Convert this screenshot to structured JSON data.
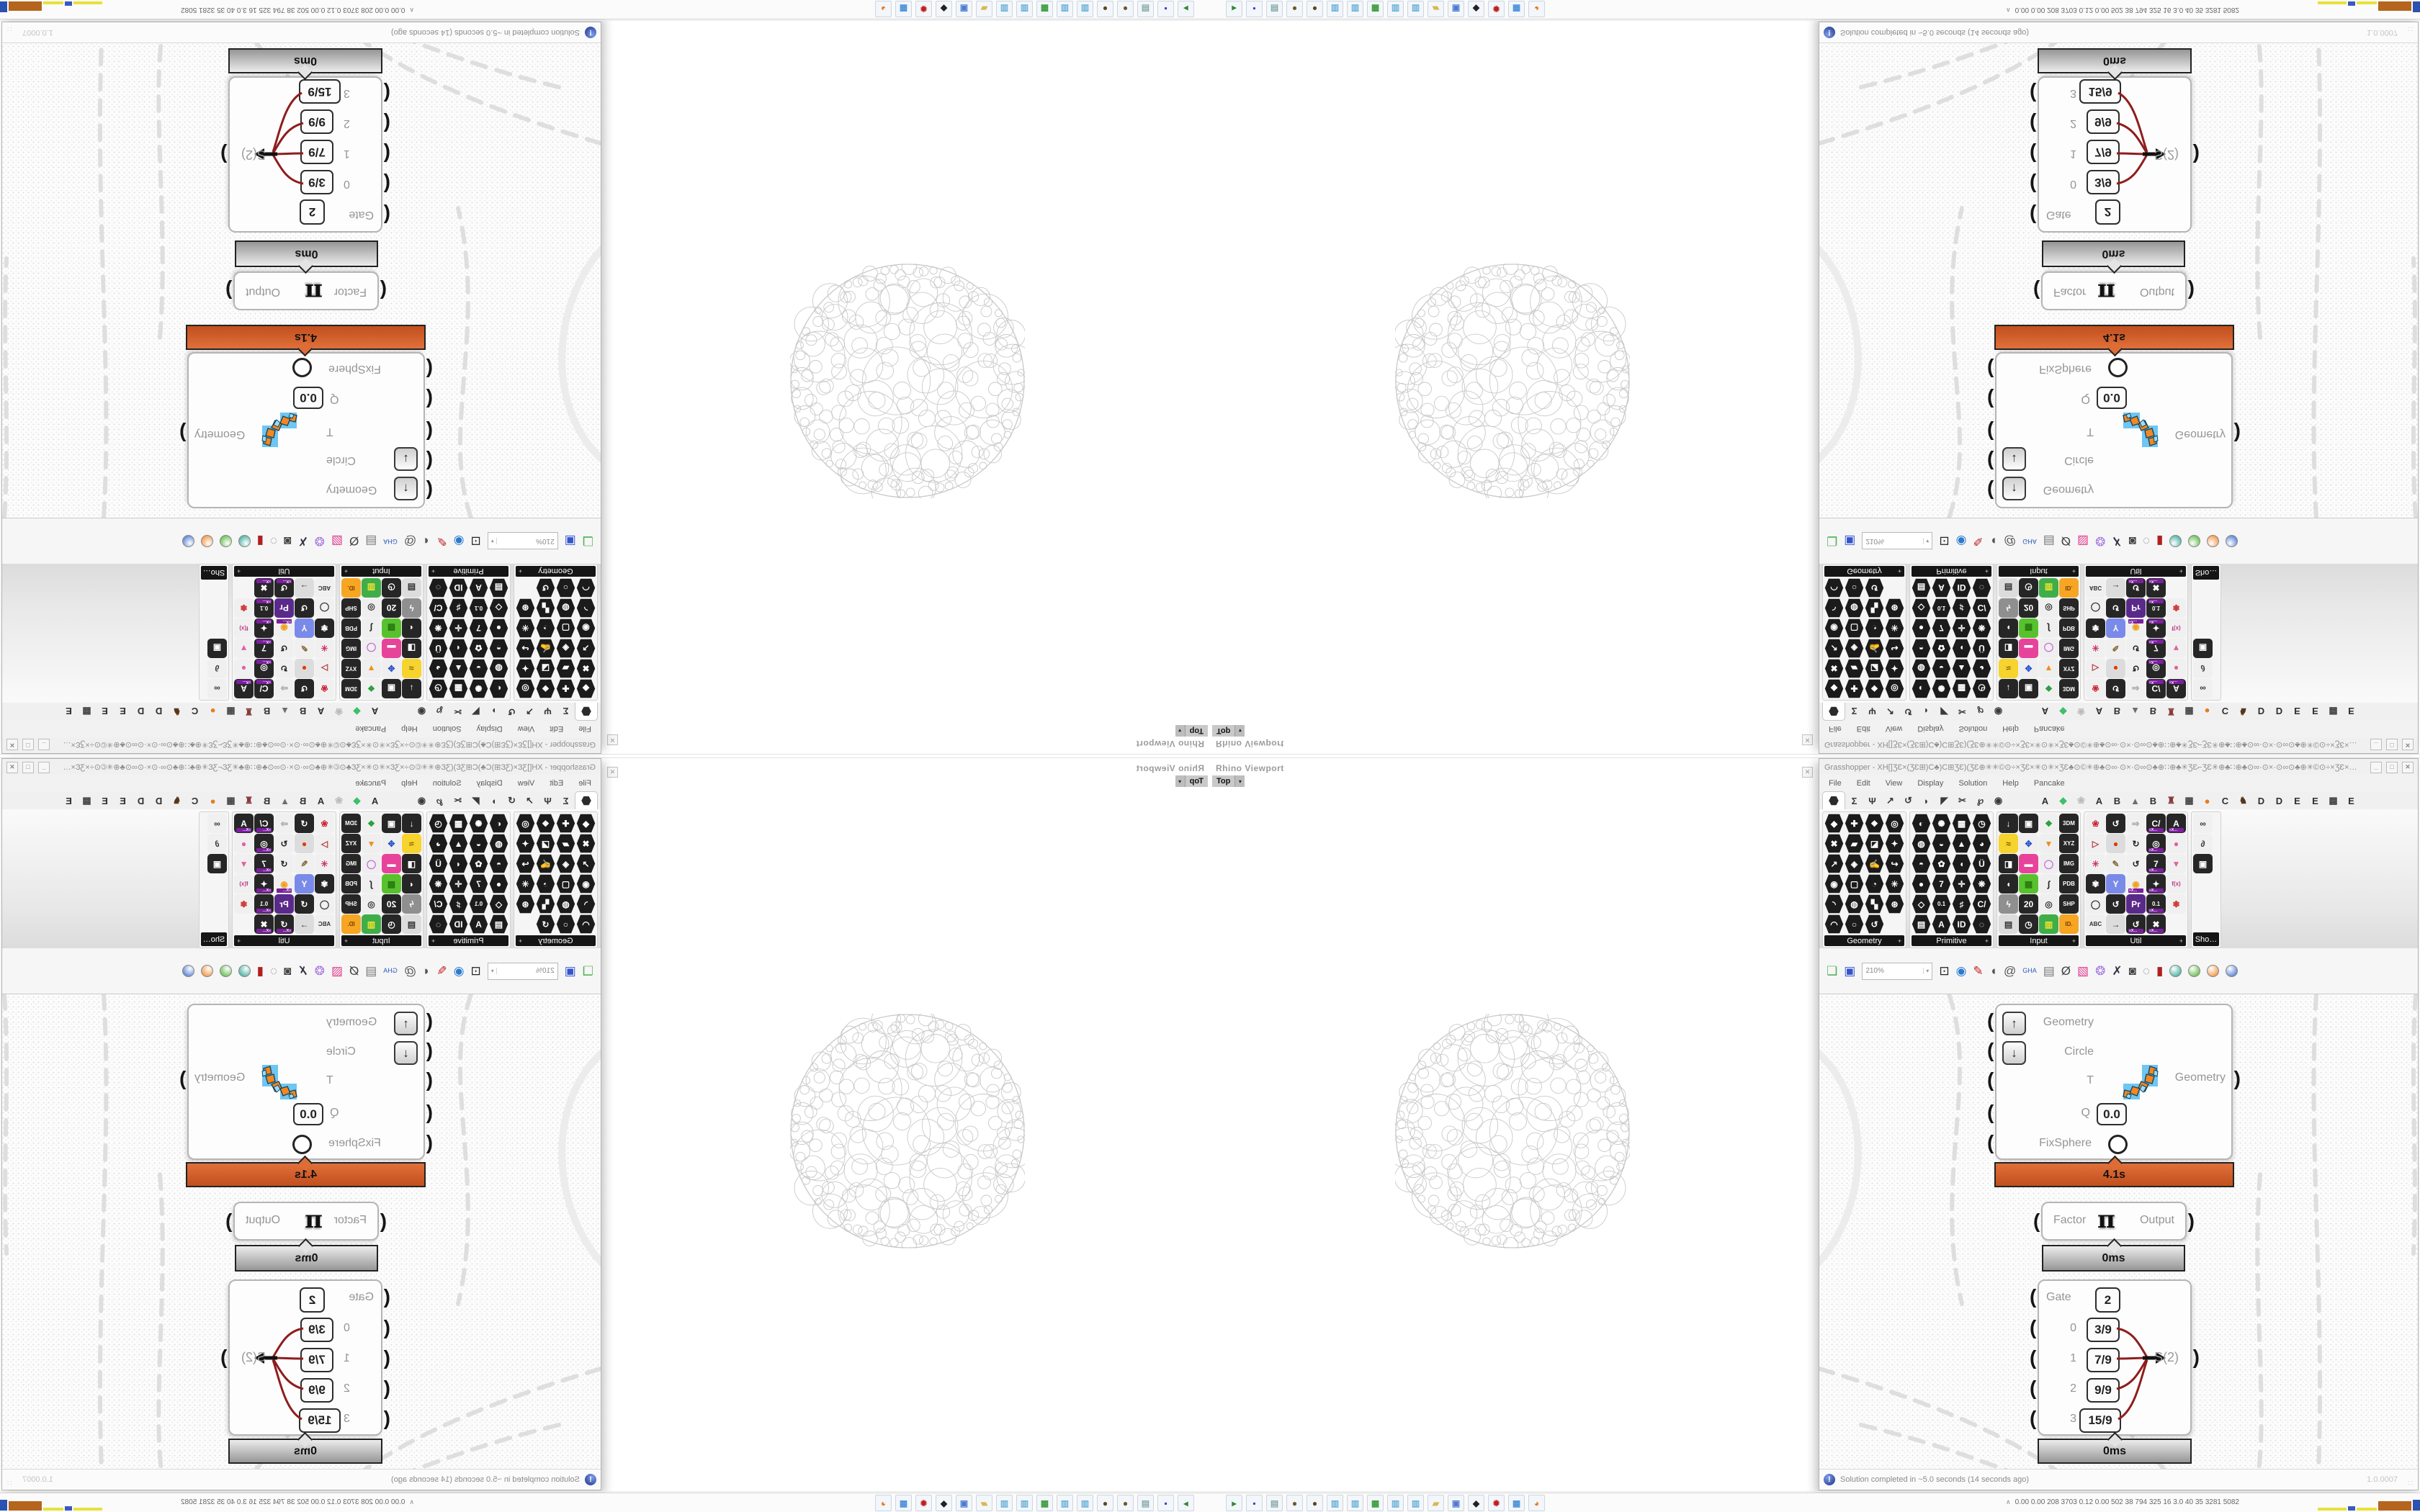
{
  "rhino": {
    "panel_title": "Rhino Viewport",
    "viewport_tab": "Top",
    "tab_arrow": "▾",
    "close_glyph": "✕"
  },
  "grasshopper": {
    "window_title": "Grasshopper - XH[]ƷƐ×(ƷƐ⊞)C♣)C⊞ƷƐ)(ƷƐ⊕✳✳©⊙÷×ƷƐ×✳⊙✳×ƷƐ♣⊙©✳⊕♣⊙∞·⊙×·⊙∞⊙♣⊕∷⊕♣✳ƷƐ⌐ƷƐ✳⊕♣∷⊕♣⊙∞·⊙×·⊙∞⊙♣⊕✳©⊙÷×ƷƐ×✳⊙✳…",
    "window_buttons": {
      "minimize": "_",
      "maximize": "□",
      "close": "✕"
    },
    "menus": [
      "File",
      "Edit",
      "View",
      "Display",
      "Solution",
      "Help",
      "Pancake"
    ],
    "tab_glyphs": [
      "Σ",
      "Ψ",
      "↗",
      "↺",
      "◗",
      "◤",
      "✂",
      "℘",
      "◉"
    ],
    "plugin_tabs": [
      {
        "g": "A",
        "c": "#2f2f2f"
      },
      {
        "g": "◆",
        "c": "#3fbf6a"
      },
      {
        "g": "❀",
        "c": "#b9b9b9"
      },
      {
        "g": "A",
        "c": "#2f2f2f"
      },
      {
        "g": "B",
        "c": "#2f2f2f"
      },
      {
        "g": "▲",
        "c": "#6d6d6d"
      },
      {
        "g": "B",
        "c": "#2f2f2f"
      },
      {
        "g": "♜",
        "c": "#8a3a3a"
      },
      {
        "g": "▦",
        "c": "#444"
      },
      {
        "g": "●",
        "c": "#e87c1e"
      },
      {
        "g": "C",
        "c": "#2f2f2f"
      },
      {
        "g": "♞",
        "c": "#57371c"
      },
      {
        "g": "D",
        "c": "#2f2f2f"
      },
      {
        "g": "D",
        "c": "#2f2f2f"
      },
      {
        "g": "E",
        "c": "#2f2f2f"
      },
      {
        "g": "E",
        "c": "#2f2f2f"
      },
      {
        "g": "▩",
        "c": "#444"
      },
      {
        "g": "E",
        "c": "#2f2f2f"
      }
    ],
    "zoom_value": "210%",
    "groups": [
      {
        "label": "Geometry",
        "cols": 4,
        "hex": true,
        "icons": [
          {
            "g": "◆"
          },
          {
            "g": "✚"
          },
          {
            "g": "❖"
          },
          {
            "g": "◎"
          },
          {
            "g": "✖"
          },
          {
            "g": "▰"
          },
          {
            "g": "◪"
          },
          {
            "g": "✦"
          },
          {
            "g": "↗"
          },
          {
            "g": "◈"
          },
          {
            "g": "✍"
          },
          {
            "g": "↪"
          },
          {
            "g": "◉"
          },
          {
            "g": "▢"
          },
          {
            "g": "◔"
          },
          {
            "g": "✳"
          },
          {
            "g": "◝"
          },
          {
            "g": "◍"
          },
          {
            "g": "▚"
          },
          {
            "g": "⊛"
          },
          {
            "g": "◠"
          },
          {
            "g": "○"
          },
          {
            "g": "↺"
          }
        ]
      },
      {
        "label": "Primitive",
        "cols": 4,
        "hex": true,
        "icons": [
          {
            "g": "◐"
          },
          {
            "g": "✺"
          },
          {
            "g": "▦"
          },
          {
            "g": "◷"
          },
          {
            "g": "◍"
          },
          {
            "g": "◒"
          },
          {
            "g": "▲"
          },
          {
            "g": "◕"
          },
          {
            "g": "◓"
          },
          {
            "g": "✿"
          },
          {
            "g": "◖"
          },
          {
            "g": "Ü"
          },
          {
            "g": "●"
          },
          {
            "g": "7"
          },
          {
            "g": "✛"
          },
          {
            "g": "❋"
          },
          {
            "g": "◇"
          },
          {
            "g": "0.1"
          },
          {
            "g": "♯"
          },
          {
            "g": "C/"
          },
          {
            "g": "▤"
          },
          {
            "g": "A"
          },
          {
            "g": "ID"
          },
          {
            "g": "◌"
          }
        ]
      },
      {
        "label": "Input",
        "cols": 4,
        "hex": false,
        "icons": [
          {
            "g": "↓",
            "b": "#262626",
            "c": "#fff"
          },
          {
            "g": "▣",
            "b": "#262626",
            "c": "#fff"
          },
          {
            "g": "❖",
            "b": "#f0f0f0",
            "c": "#2aa13c"
          },
          {
            "g": "3DM",
            "b": "#262626",
            "c": "#fff"
          },
          {
            "g": "≈",
            "b": "#f6d32d",
            "c": "#7a5a00"
          },
          {
            "g": "✥",
            "b": "#efefef",
            "c": "#2a55cc"
          },
          {
            "g": "▼",
            "b": "#efefef",
            "c": "#f08c1a"
          },
          {
            "g": "XYZ",
            "b": "#262626",
            "c": "#fff"
          },
          {
            "g": "◨",
            "b": "#262626",
            "c": "#fff"
          },
          {
            "g": "▬",
            "b": "#e8439a",
            "c": "#fff"
          },
          {
            "g": "◯",
            "b": "#efefef",
            "c": "#c66ad8"
          },
          {
            "g": "IMG",
            "b": "#262626",
            "c": "#fff"
          },
          {
            "g": "◖",
            "b": "#262626",
            "c": "#fff"
          },
          {
            "g": "▩",
            "b": "#57c22d",
            "c": "#2a7a12"
          },
          {
            "g": "∫",
            "b": "#efefef",
            "c": "#222"
          },
          {
            "g": "PDB",
            "b": "#262626",
            "c": "#fff"
          },
          {
            "g": "ϟ",
            "b": "#8f8f8f",
            "c": "#fff"
          },
          {
            "g": "20",
            "b": "#262626",
            "c": "#fff"
          },
          {
            "g": "◎",
            "b": "#efefef",
            "c": "#333"
          },
          {
            "g": "SHP",
            "b": "#262626",
            "c": "#fff"
          },
          {
            "g": "▤",
            "b": "#dcdcdc",
            "c": "#333"
          },
          {
            "g": "◷",
            "b": "#262626",
            "c": "#fff"
          },
          {
            "g": "▥",
            "b": "#3fae49",
            "c": "#f0e130"
          },
          {
            "g": "ID.",
            "b": "#f6a623",
            "c": "#7a3c00"
          }
        ]
      },
      {
        "label": "Util",
        "cols": 5,
        "hex": false,
        "icons": [
          {
            "g": "❀",
            "b": "#f0f0f0",
            "c": "#cc2233"
          },
          {
            "g": "↺",
            "b": "#262626",
            "c": "#fff"
          },
          {
            "g": "⇨",
            "b": "#f0f0f0",
            "c": "#9a9a9a"
          },
          {
            "g": "C/",
            "b": "#262626",
            "c": "#fff",
            "x": true
          },
          {
            "g": "A",
            "b": "#262626",
            "c": "#fff",
            "x": true
          },
          {
            "g": "▷",
            "b": "#f0f0f0",
            "c": "#b23a3a"
          },
          {
            "g": "●",
            "b": "#dcdcdc",
            "c": "#e03c00"
          },
          {
            "g": "↻",
            "b": "#f0f0f0",
            "c": "#222"
          },
          {
            "g": "◎",
            "b": "#262626",
            "c": "#fff",
            "x": true
          },
          {
            "g": "●",
            "b": "#f0f0f0",
            "c": "#e060a0"
          },
          {
            "g": "✳",
            "b": "#f0f0f0",
            "c": "#cc3366"
          },
          {
            "g": "✎",
            "b": "#f0f0f0",
            "c": "#8a6a3a"
          },
          {
            "g": "↺",
            "b": "#f0f0f0",
            "c": "#222"
          },
          {
            "g": "7",
            "b": "#262626",
            "c": "#fff",
            "x": true
          },
          {
            "g": "▼",
            "b": "#f0f0f0",
            "c": "#e060a0"
          },
          {
            "g": "✾",
            "b": "#262626",
            "c": "#fff"
          },
          {
            "g": "Y",
            "b": "#7a8ae8",
            "c": "#fff"
          },
          {
            "g": "◉",
            "b": "#f0f0f0",
            "c": "#f0a020",
            "x": true
          },
          {
            "g": "✦",
            "b": "#262626",
            "c": "#fff",
            "x": true
          },
          {
            "g": "f(x)",
            "b": "#f0f0f0",
            "c": "#c03a8a"
          },
          {
            "g": "◯",
            "b": "#f0f0f0",
            "c": "#333"
          },
          {
            "g": "↺",
            "b": "#262626",
            "c": "#fff"
          },
          {
            "g": "Pr",
            "b": "#5a2a8a",
            "c": "#fff"
          },
          {
            "g": "0.1",
            "b": "#262626",
            "c": "#fff",
            "x": true
          },
          {
            "g": "✽",
            "b": "#f0f0f0",
            "c": "#d04040"
          },
          {
            "g": "ABC",
            "b": "#f0f0f0",
            "c": "#333"
          },
          {
            "g": "→",
            "b": "#dcdcdc",
            "c": "#333"
          },
          {
            "g": "↺",
            "b": "#262626",
            "c": "#fff",
            "x": true
          },
          {
            "g": "✖",
            "b": "#262626",
            "c": "#fff",
            "x": true
          }
        ]
      }
    ],
    "partial_group": {
      "label": "Sho…",
      "icons": [
        {
          "g": "∞",
          "b": "#f0f0f0",
          "c": "#333"
        },
        {
          "g": "∂",
          "b": "#f0f0f0",
          "c": "#333"
        },
        {
          "g": "▣",
          "b": "#262626",
          "c": "#fff"
        }
      ]
    },
    "toolbar_icons": [
      {
        "n": "open-file-icon",
        "g": "❏",
        "c": "#4caf50"
      },
      {
        "n": "save-file-icon",
        "g": "▣",
        "c": "#3355cc"
      },
      {
        "n": "zoom-extents-icon",
        "g": "⊡",
        "c": "#222"
      },
      {
        "n": "preview-eye-icon",
        "g": "◉",
        "c": "#2a7ad0"
      },
      {
        "n": "sketch-pen-icon",
        "g": "✎",
        "c": "#c02020"
      },
      {
        "n": "megaphone-icon",
        "g": "◖",
        "c": "#555"
      },
      {
        "n": "at-icon",
        "g": "@",
        "c": "#555"
      },
      {
        "n": "gha-globe-icon",
        "g": "GHA",
        "c": "#2a5ac0"
      },
      {
        "n": "document-icon",
        "g": "▤",
        "c": "#777"
      },
      {
        "n": "search-icon",
        "g": "Ø",
        "c": "#444"
      },
      {
        "n": "package-icon",
        "g": "▧",
        "c": "#e23a8e"
      },
      {
        "n": "balloon-icon",
        "g": "❂",
        "c": "#a478e0"
      },
      {
        "n": "wires-icon",
        "g": "✗",
        "c": "#334"
      },
      {
        "n": "camera-icon",
        "g": "◙",
        "c": "#444"
      },
      {
        "n": "rings-icon",
        "g": "◌",
        "c": "#888"
      },
      {
        "n": "barrel-icon",
        "g": "▮",
        "c": "#b02020"
      }
    ],
    "pin_colors": [
      "#20a090",
      "#45b02a",
      "#f08020",
      "#3366cc"
    ],
    "status": {
      "text": "Solution completed in ~5.0 seconds (14 seconds ago)",
      "version": "1.0.0007",
      "grip": "∷"
    },
    "components": {
      "cluster": {
        "inputs": [
          "Geometry",
          "Circle",
          "T",
          "Q",
          "FixSphere"
        ],
        "q_value": "0.0",
        "output": "Geometry",
        "up_arrow": "↑",
        "down_arrow": "↓",
        "profiler": "4.1s"
      },
      "pi": {
        "input": "Factor",
        "symbol": "π",
        "output": "Output",
        "profiler": "0ms"
      },
      "gate": {
        "gate_label": "Gate",
        "gate_value": "2",
        "items": [
          {
            "i": "0",
            "v": "3/9"
          },
          {
            "i": "1",
            "v": "7/9"
          },
          {
            "i": "2",
            "v": "9/9"
          },
          {
            "i": "3",
            "v": "15/9"
          }
        ],
        "output": "S(2)",
        "profiler": "0ms"
      }
    }
  },
  "os_bar": {
    "expander": "∧",
    "stats": "0.00  0.00  208  3703  0.12  0.00  502   38   794   325   16   3.0   40   35   3281 5082",
    "app_icons": [
      {
        "n": "terminal-app-icon",
        "g": "▸",
        "c": "#2a8a2a"
      },
      {
        "n": "floppy-app-icon",
        "g": "▪",
        "c": "#3a3ad0"
      },
      {
        "n": "notes-app-icon",
        "g": "▤",
        "c": "#8aa"
      },
      {
        "n": "cookie-app-icon",
        "g": "●",
        "c": "#6a5a2a"
      },
      {
        "n": "cookie2-app-icon",
        "g": "●",
        "c": "#5a4a20"
      },
      {
        "n": "pad-app-icon",
        "g": "▥",
        "c": "#6ab0d8"
      },
      {
        "n": "pad2-app-icon",
        "g": "▥",
        "c": "#6ab0d8"
      },
      {
        "n": "monitor-app-icon",
        "g": "▦",
        "c": "#3a9a3a"
      },
      {
        "n": "pad3-app-icon",
        "g": "▥",
        "c": "#6ab0d8"
      },
      {
        "n": "pad4-app-icon",
        "g": "▥",
        "c": "#6ab0d8"
      },
      {
        "n": "folder-app-icon",
        "g": "▰",
        "c": "#d8b84a"
      },
      {
        "n": "display-app-icon",
        "g": "▣",
        "c": "#4a7ad0"
      },
      {
        "n": "art-app-icon",
        "g": "◆",
        "c": "#222"
      },
      {
        "n": "red-app-icon",
        "g": "✹",
        "c": "#c02020"
      },
      {
        "n": "calc-app-icon",
        "g": "▦",
        "c": "#4a90d8"
      },
      {
        "n": "fox-app-icon",
        "g": "◕",
        "c": "#e87820"
      }
    ],
    "sparkline": [
      {
        "c": "#e8e13a",
        "w": 40,
        "h": 4
      },
      {
        "c": "#3a59c2",
        "w": 10,
        "h": 6
      },
      {
        "c": "#e8e13a",
        "w": 28,
        "h": 4
      },
      {
        "c": "#b5651d",
        "w": 46,
        "h": 13
      },
      {
        "c": "#2a52b0",
        "w": 44,
        "h": 15
      },
      {
        "c": "#b5651d",
        "w": 42,
        "h": 13
      },
      {
        "c": "#4cc24c",
        "w": 22,
        "h": 4
      },
      {
        "c": "#c03030",
        "w": 38,
        "h": 6
      }
    ]
  }
}
